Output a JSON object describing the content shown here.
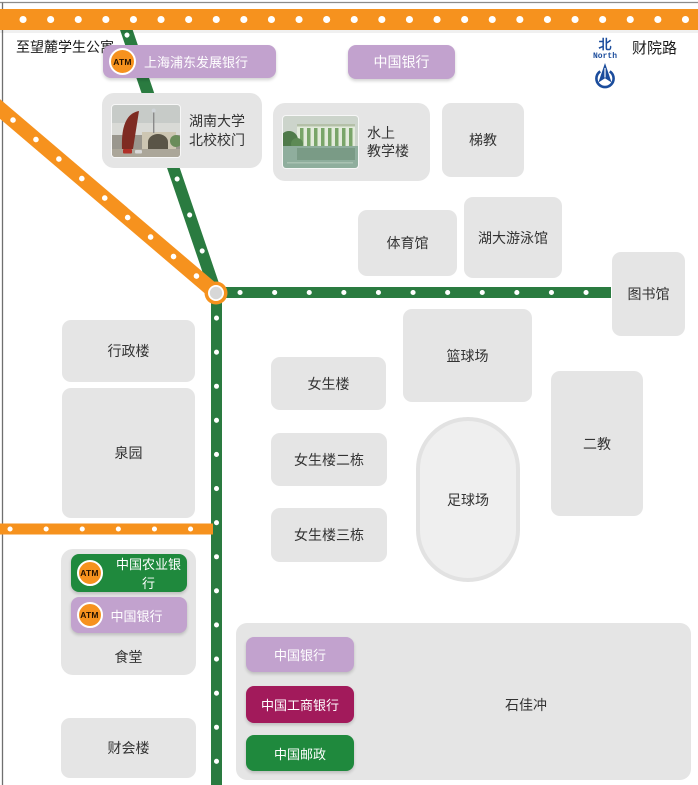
{
  "colors": {
    "road_orange": "#F6921E",
    "road_green": "#2A7B40",
    "card_gray": "#E5E5E5",
    "bank_purple": "#C2A2CE",
    "bank_maroon": "#A21A5B",
    "bank_green": "#1F893D",
    "compass_blue": "#1B4C9C"
  },
  "top": {
    "left_road_label": "至望麓学生公寓",
    "right_road_label": "财院路"
  },
  "compass": {
    "zh": "北",
    "en": "North"
  },
  "pois": {
    "spdb_atm": "ATM",
    "spdb": "上海浦东发展银行",
    "boc_top": "中国银行",
    "gate_line1": "湖南大学",
    "gate_line2": "北校校门",
    "water_line1": "水上",
    "water_line2": "教学楼",
    "tijiao": "梯教",
    "gym": "体育馆",
    "pool": "湖大游泳馆",
    "library": "图书馆",
    "admin": "行政楼",
    "quanyuan": "泉园",
    "girls1": "女生楼",
    "basketball": "篮球场",
    "girls2": "女生楼二栋",
    "football": "足球场",
    "erjiao": "二教",
    "girls3": "女生楼三栋",
    "canteen": "食堂",
    "abc_atm": "ATM",
    "abc": "中国农业银行",
    "boc_canteen_atm": "ATM",
    "boc_canteen": "中国银行",
    "finance_bldg": "财会楼",
    "shijiachong": "石佳冲",
    "legend_boc": "中国银行",
    "legend_icbc": "中国工商银行",
    "legend_post": "中国邮政"
  }
}
